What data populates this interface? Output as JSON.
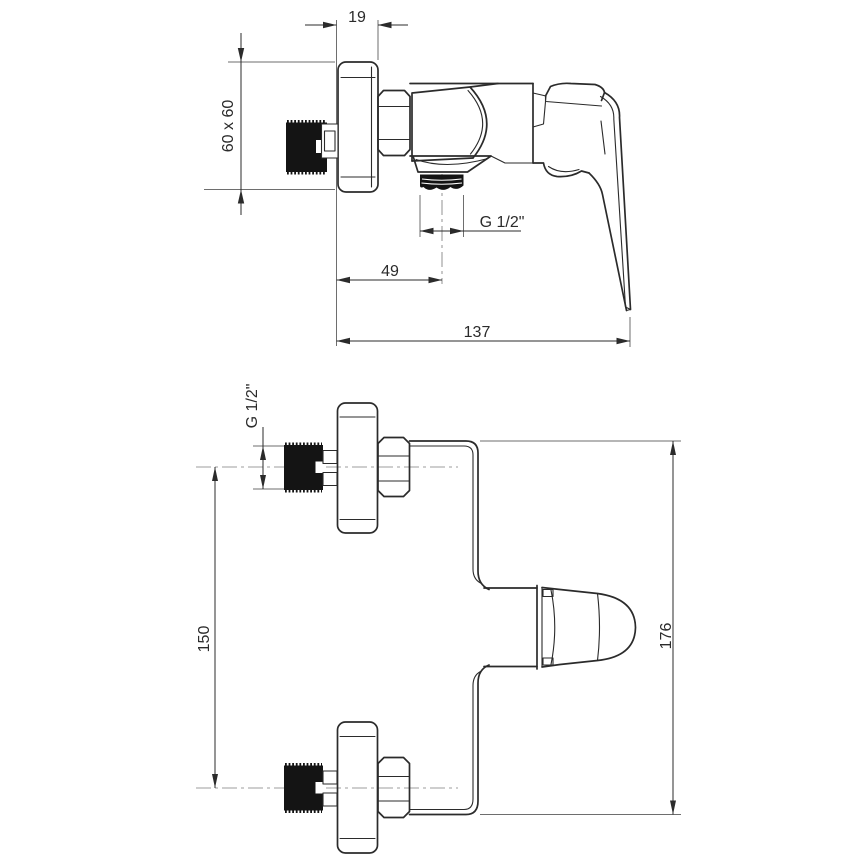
{
  "colors": {
    "line": "#2b2b2b",
    "thin": "#6e6e6e",
    "centerline": "#9c9c9c",
    "fill": "#141414",
    "background": "#ffffff"
  },
  "side": {
    "dims": {
      "plate_depth": "19",
      "plate_size": "60 x 60",
      "outlet_thread": "G 1/2\"",
      "outlet_offset": "49",
      "total_depth": "137"
    }
  },
  "front": {
    "dims": {
      "inlet_thread": "G 1/2\"",
      "inlet_spacing": "150",
      "total_height": "176"
    }
  }
}
